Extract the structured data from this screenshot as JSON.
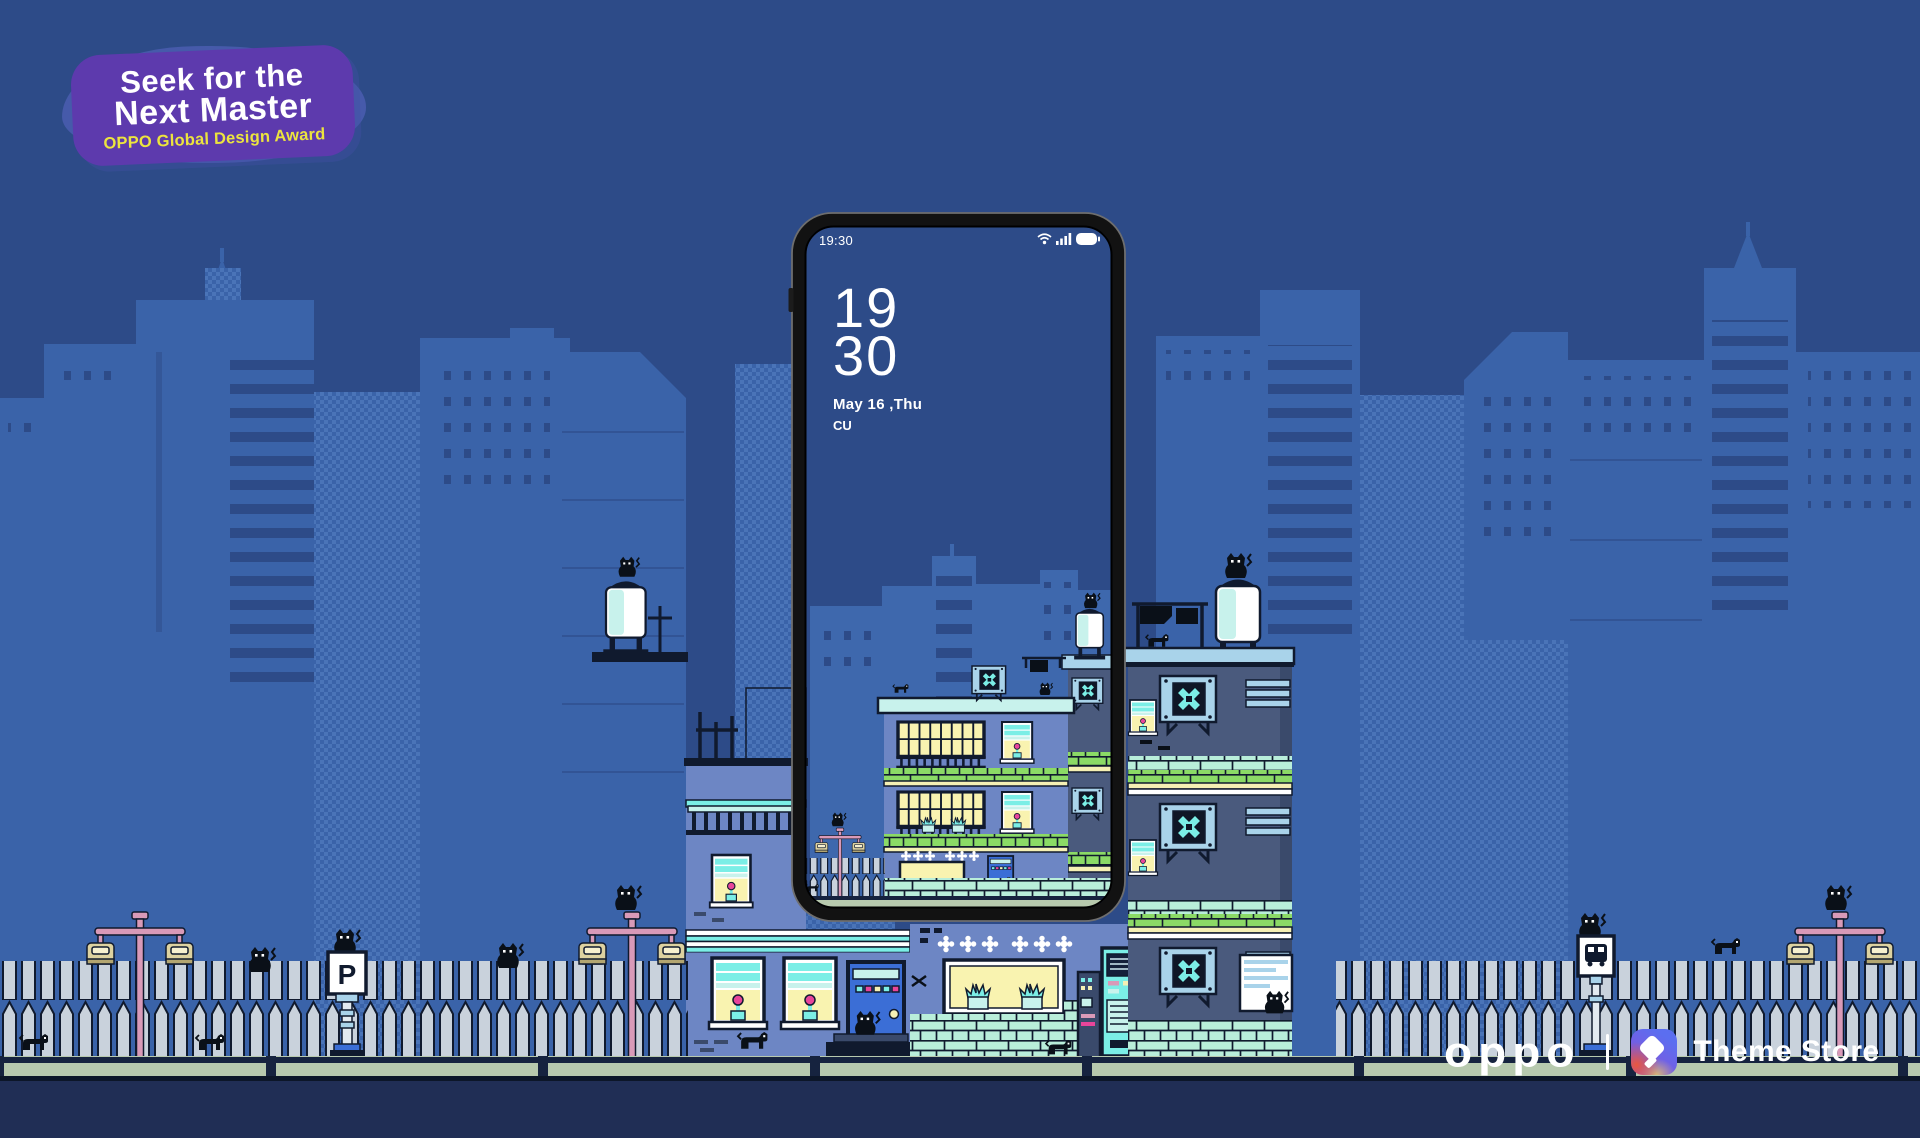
{
  "badge": {
    "title_line1": "Seek for the",
    "title_line2": "Next Master",
    "subtitle": "OPPO Global Design Award"
  },
  "phone": {
    "status_bar": {
      "time": "19:30",
      "icons": [
        "wifi-icon",
        "signal-bars-icon",
        "battery-icon"
      ]
    },
    "lock_screen": {
      "hour": "19",
      "minute": "30",
      "date": "May 16 ,Thu",
      "carrier": "CU"
    }
  },
  "scene": {
    "parking_sign_letter": "P",
    "signs": [
      "parking-sign",
      "bus-stop-sign"
    ],
    "props": [
      "black-cat",
      "pink-street-lamp",
      "picket-fence",
      "water-tank",
      "ac-fan-unit",
      "laundry-line",
      "vending-machine"
    ]
  },
  "footer": {
    "brand_logo": "oppo",
    "app_name": "Theme Store"
  },
  "palette": {
    "sky": "#2d4b88",
    "skyline": "#3a63a9",
    "skytex": "#4a74b8",
    "skylineIn": "#3e68ad",
    "peri": "#6d86c4",
    "periLight": "#93a8d8",
    "slate": "#4a5a7d",
    "slateDark": "#3a4a6b",
    "steel": "#a9d3ea",
    "aqua": "#7beee6",
    "aquaPale": "#c8f2ec",
    "winYellow": "#f9f3b0",
    "green": "#8bda66",
    "mint": "#b9eeda",
    "cream": "#f5f0b4",
    "ink": "#101a2e",
    "catBlack": "#0a1018",
    "doorBlue": "#3b6ed6",
    "pink": "#d99ab8",
    "tan": "#ddd2a0",
    "tanDark": "#b3a671",
    "fence": "#c9d2dc",
    "ground": "#b7c9ae",
    "groundDark": "#16233f",
    "navy": "#202e55",
    "blob": "#5d3aad",
    "blobHalo": "#5563bd",
    "badgeYellow": "#ece43e",
    "iconBlue": "#5b6ef0",
    "iconRed": "#e8573f",
    "iconSand": "#d8b878",
    "bezel": "#121212",
    "bezelEdge": "#6e6e6e",
    "flowerPink": "#e8459a"
  }
}
